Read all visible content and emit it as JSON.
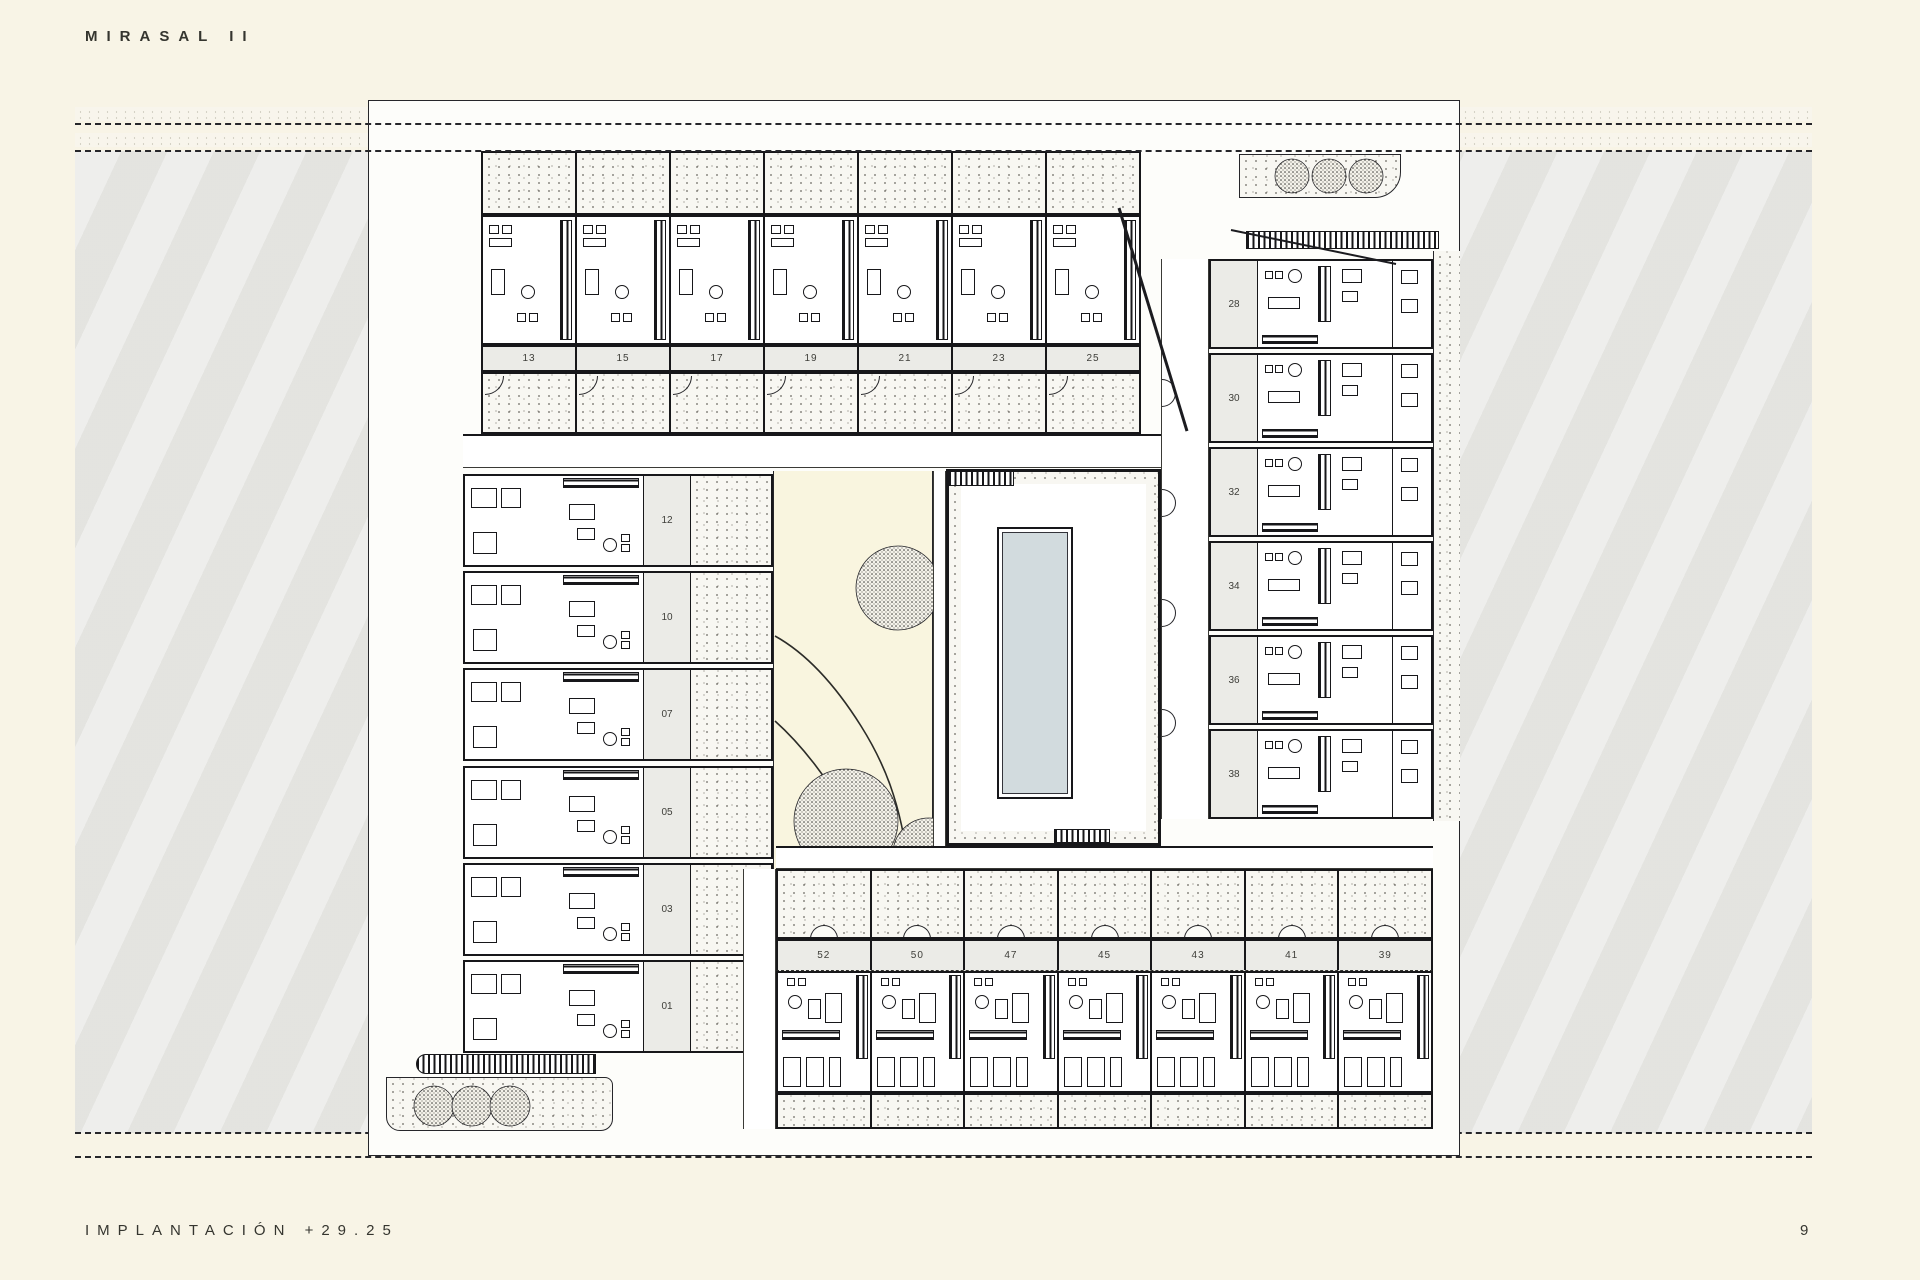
{
  "page": {
    "title": "MIRASAL II",
    "caption": "IMPLANTACIÓN +29.25",
    "page_number": "9"
  },
  "plan": {
    "top_row_units": [
      "13",
      "15",
      "17",
      "19",
      "21",
      "23",
      "25"
    ],
    "left_wing_units": [
      "12",
      "10",
      "07",
      "05",
      "03",
      "01"
    ],
    "right_wing_units": [
      "28",
      "30",
      "32",
      "34",
      "36",
      "38"
    ],
    "bottom_row_units": [
      "52",
      "50",
      "47",
      "45",
      "43",
      "41",
      "39"
    ]
  },
  "colors": {
    "page_bg": "#f8f4e6",
    "surround_gray": "#e8e8e4",
    "garden_cream": "#f9f5df",
    "pool_water": "#d2dbde",
    "ink": "#17171a",
    "label_band": "#ebebe7"
  }
}
